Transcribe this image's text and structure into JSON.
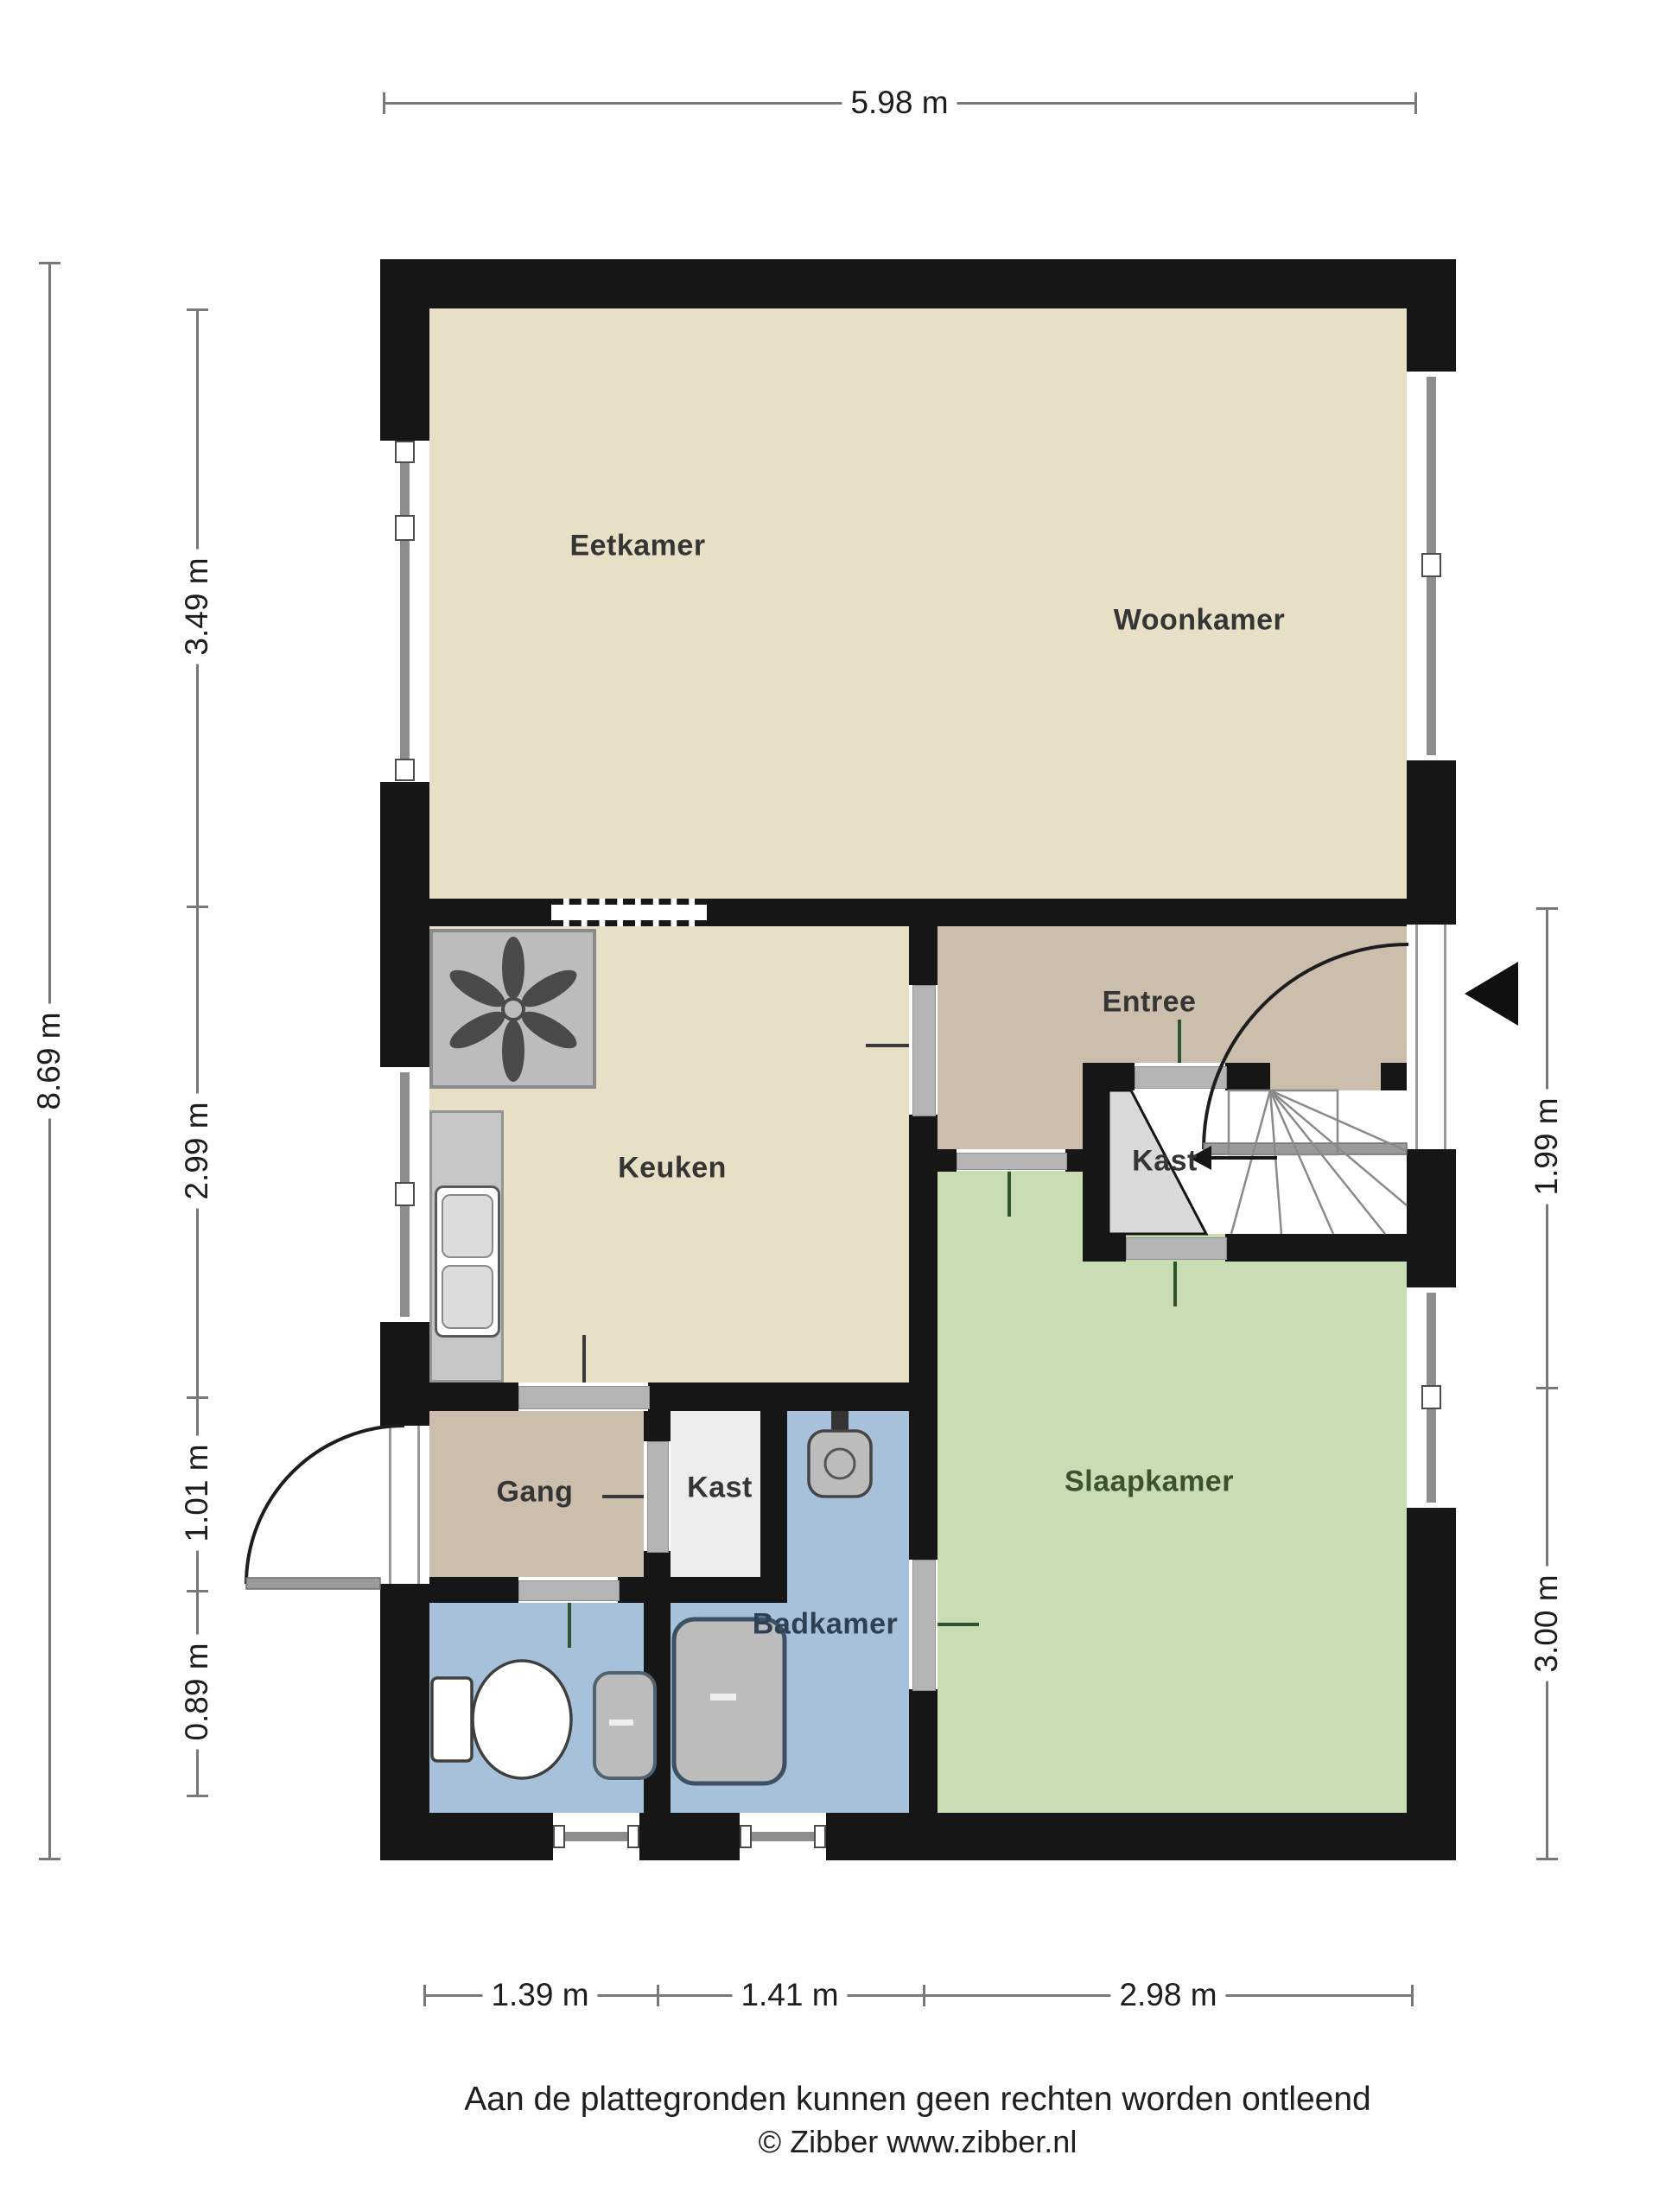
{
  "title": "Begane grond plattegrond",
  "colors": {
    "wall": "#161616",
    "beige": "#e8e0c6",
    "tan": "#cbbeac",
    "green": "#c9ddb4",
    "blue": "#a8c1db",
    "kastWhite": "#ededed",
    "kastGray": "#d9d9d9",
    "counter": "#c6c6c6",
    "fixGray": "#bcbcbc",
    "winGray": "#8e8e8e",
    "doorGray": "#b4b4b4",
    "dim": "#787878",
    "label": "#353535",
    "slaapLabel": "#39522f",
    "badLabel": "#2e4054",
    "tickDark": "#3a3a3a",
    "tickGreen": "#2f5430"
  },
  "rooms": {
    "eetkamer": "Eetkamer",
    "woonkamer": "Woonkamer",
    "keuken": "Keuken",
    "entree": "Entree",
    "kast_stairs": "Kast",
    "slaapkamer": "Slaapkamer",
    "gang": "Gang",
    "kast_small": "Kast",
    "badkamer": "Badkamer"
  },
  "dimensions": {
    "top": "5.98 m",
    "left_total": "8.69 m",
    "left_inner": [
      "3.49 m",
      "2.99 m",
      "1.01 m",
      "0.89 m"
    ],
    "right": [
      "1.99 m",
      "3.00 m"
    ],
    "bottom": [
      "1.39 m",
      "1.41 m",
      "2.98 m"
    ]
  },
  "footer": {
    "disclaimer": "Aan de plattegronden kunnen geen rechten worden ontleend",
    "copyright": "© Zibber www.zibber.nl"
  }
}
